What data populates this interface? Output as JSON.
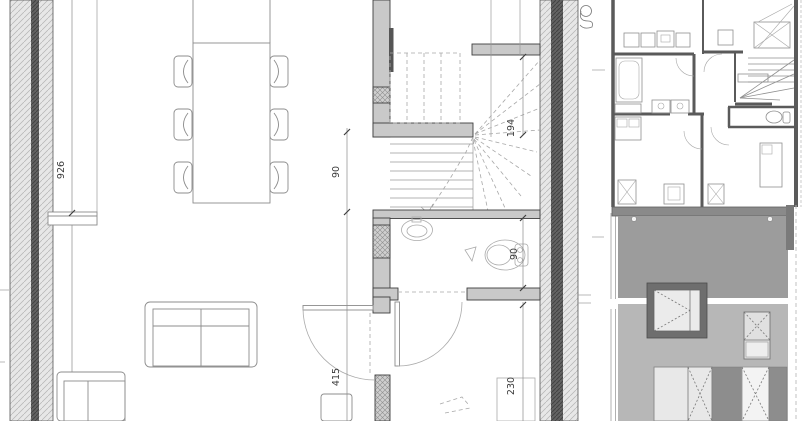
{
  "document": {
    "type": "architectural drawing sheet",
    "views": {
      "main": "ground floor plan with winder stair, wc and living room",
      "top_right": "upper floor plan thumbnail",
      "bottom_right": "street facade elevation"
    }
  },
  "plan": {
    "dimensions": {
      "room_length": "926",
      "stair_passage_width": "90",
      "stair_depth": "194",
      "wc_toilet_width": "90",
      "hall_length": "415",
      "entry_width": "230"
    }
  },
  "colors": {
    "wall_fill": "#c9c9c9",
    "insulation_core": "#5f5f5f",
    "elevation_roof_band": "#8a8a8a",
    "elevation_upper_wall": "#9c9c9c",
    "elevation_lower_wall": "#b7b7b7",
    "window_frame": "#6e6e6e"
  }
}
